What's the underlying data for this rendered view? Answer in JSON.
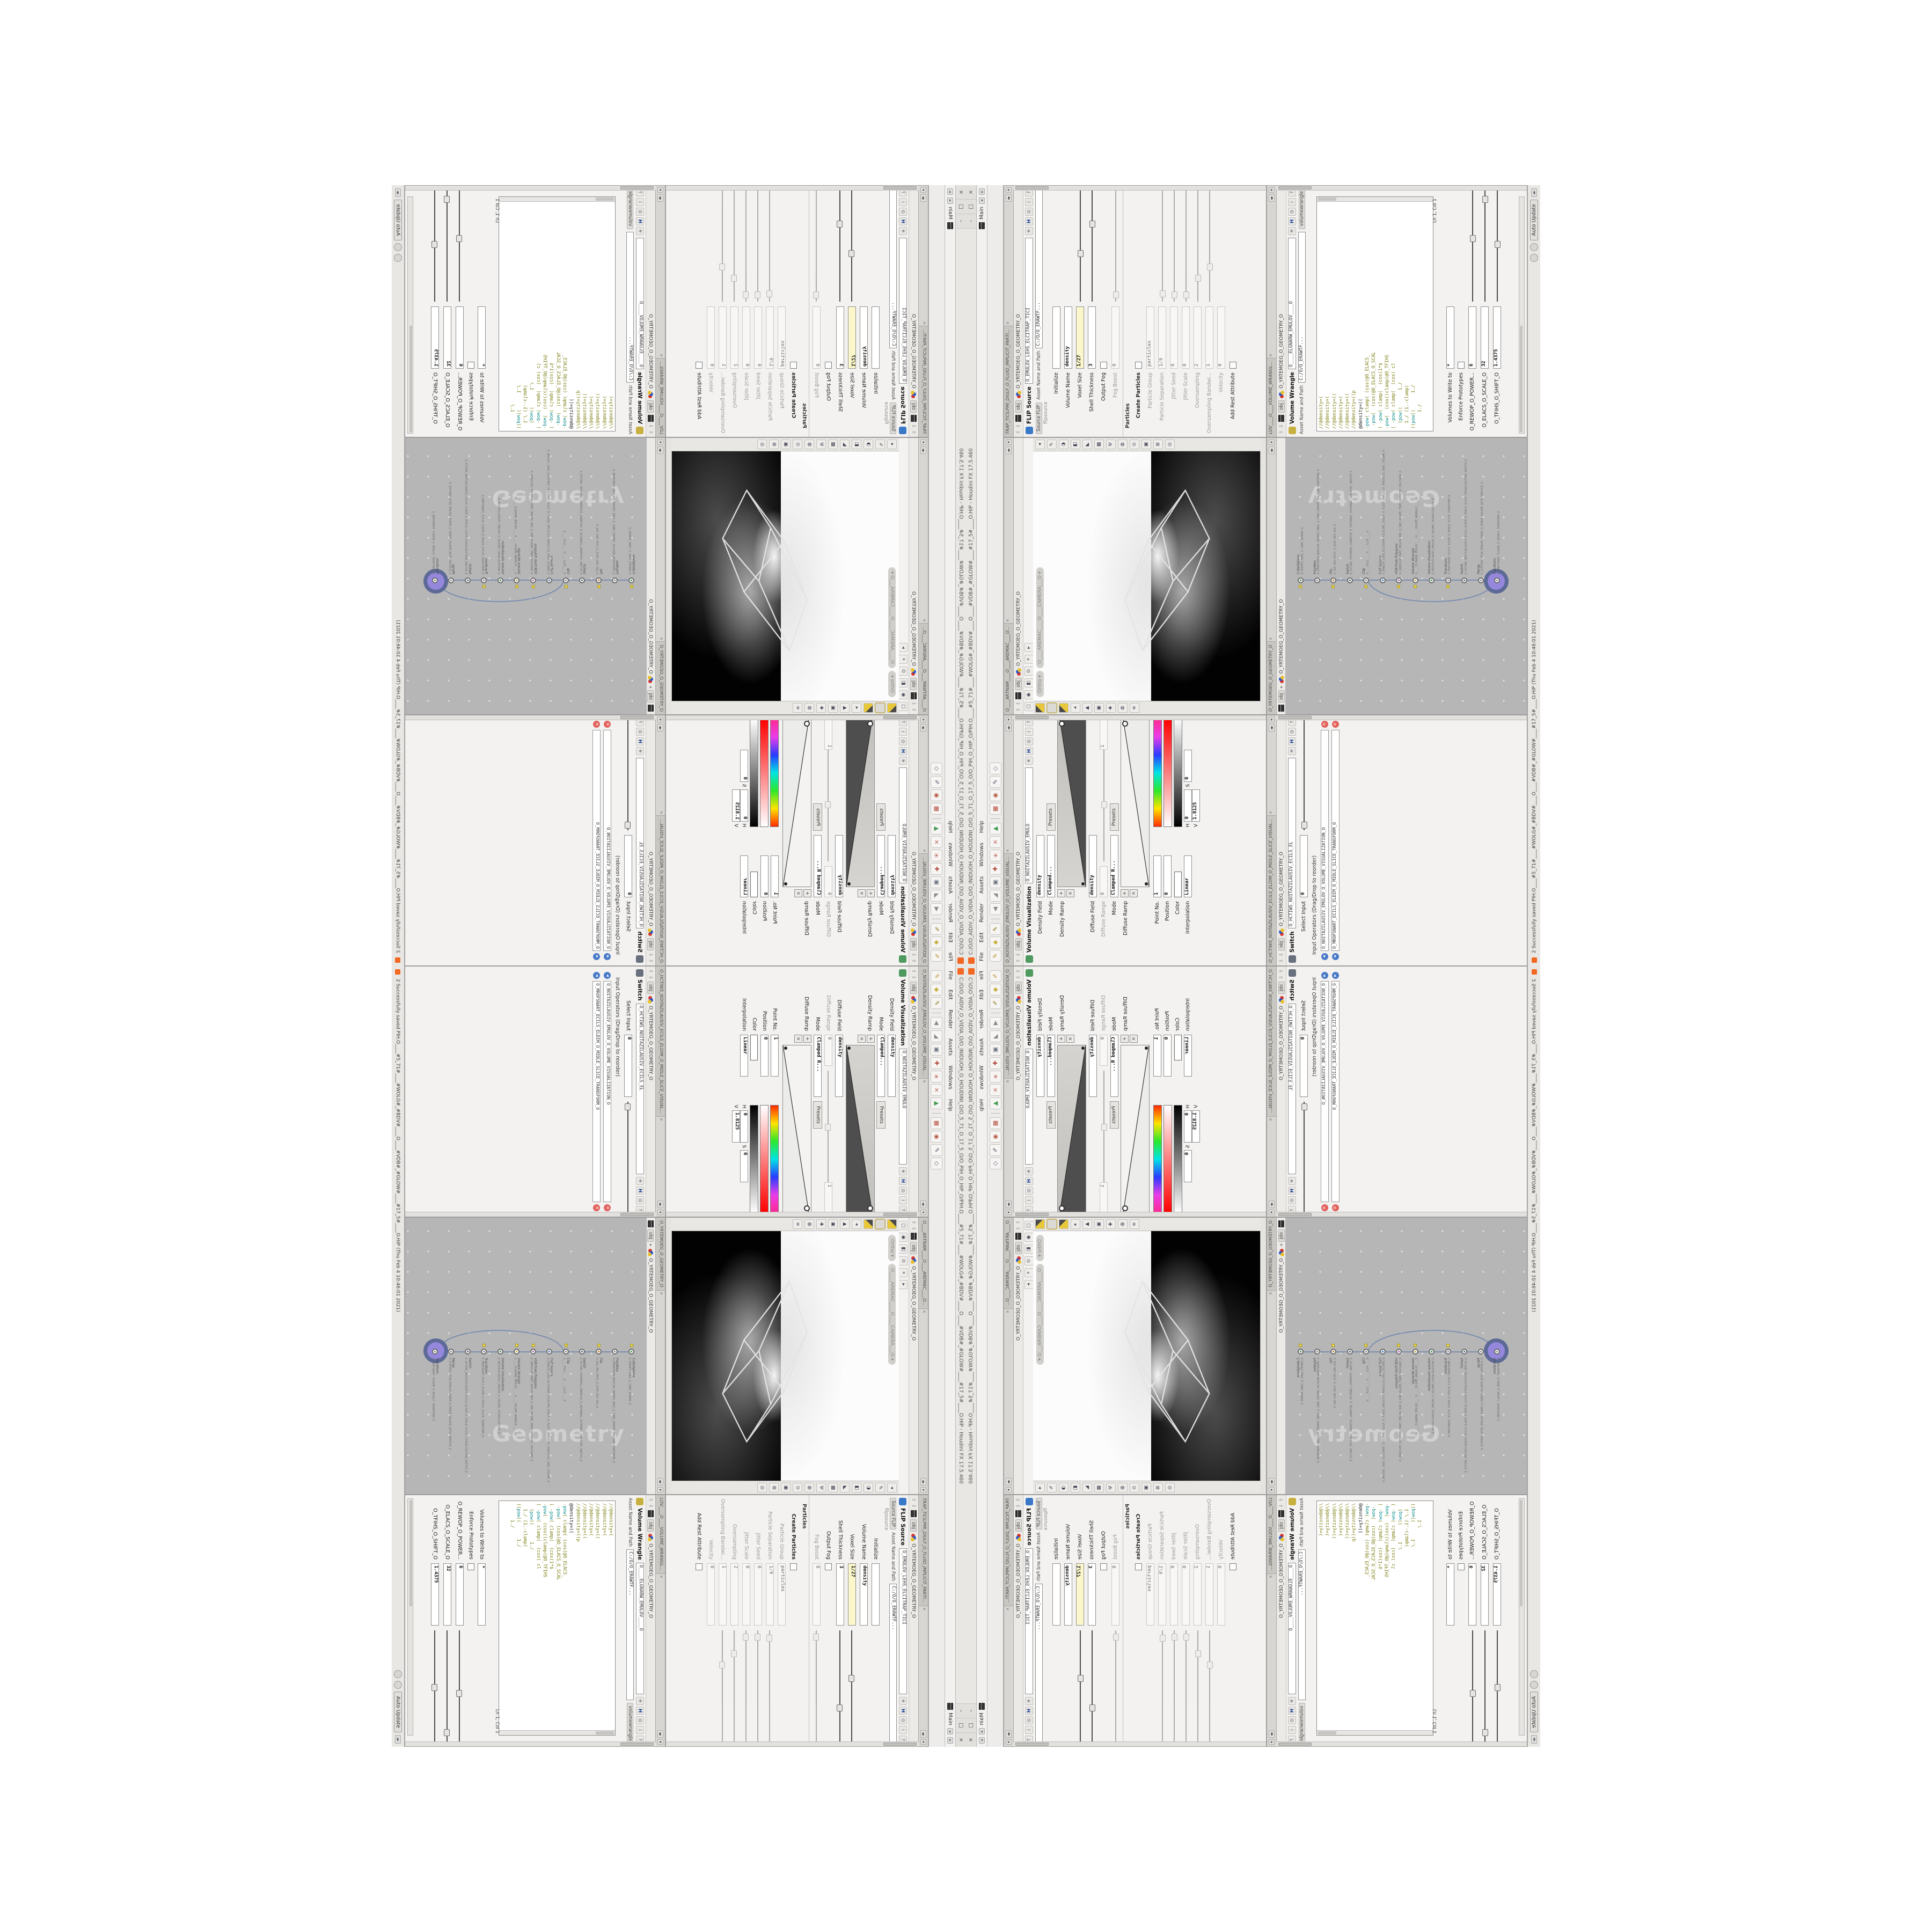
{
  "colors": {
    "accent_purple": "#9487dc",
    "ring_slate": "#5d6a97",
    "network_bg": "#b6b6b6",
    "code_olive": "#7e7e14",
    "code_teal": "#0c8c8c",
    "yellow_field": "#fbf7cb",
    "flag_yellow": "#e4cf47",
    "close_red": "#e2615c",
    "link_blue": "#4a7ac8",
    "houdini_orange": "#f26722"
  },
  "window": {
    "title": "C:/O/O_AIDIV_O_VIDIA_O/O_INIDUOH_O_HOUDINI_O/O_5_71_O_17_5_O/O_PIH_O_HIP_O/PIH.O____#5_71#____#WOLG#_#BDV#____O____#VDB#_#GLOW#____#17_5#____O.HIP - Houdini FX 17.5.460",
    "btn_min": "–",
    "btn_max": "□",
    "btn_close": "×"
  },
  "menubar": {
    "menus": [
      "File",
      "Edit",
      "Render",
      "Assets",
      "Windows",
      "Help"
    ],
    "desktop_label": "Main",
    "nav_left": "◂",
    "nav_right": "▸"
  },
  "shelf": {
    "icons": [
      {
        "g": "✎",
        "c": "#b9952e"
      },
      {
        "g": "◆",
        "c": "#c8b040"
      },
      {
        "g": "✎",
        "c": "#8f7a20"
      },
      {
        "g": "|",
        "c": "#999"
      },
      {
        "g": "◀",
        "c": "#8a8a8a"
      },
      {
        "g": "◢",
        "c": "#8a8a8a"
      },
      {
        "g": "▣",
        "c": "#68707e"
      },
      {
        "g": "✚",
        "c": "#b3493a"
      },
      {
        "g": "＊",
        "c": "#b3493a"
      },
      {
        "g": "×",
        "c": "#b3493a"
      },
      {
        "g": "▲",
        "c": "#3f9a4f"
      },
      {
        "g": "|",
        "c": "#999"
      },
      {
        "g": "▦",
        "c": "#b3493a"
      },
      {
        "g": "◉",
        "c": "#b3543c"
      },
      {
        "g": "✎",
        "c": "#5a6070"
      },
      {
        "g": "◇",
        "c": "#5a6070"
      }
    ]
  },
  "volvis": {
    "tab": "O_NOITAZILAUSIV_EMULOV_O_VOLUME_VISUAL...",
    "context": "obj",
    "path": "O_YRTEMOEG_O_GEOMETRY_O",
    "type_label": "Volume Visualization",
    "name": "O_NOITAZILAUSIV_EMULO",
    "density_field_label": "Density Field",
    "density_field": "density",
    "mode_label": "Mode",
    "mode": "Clamped...",
    "presets": "Presets",
    "density_ramp_label": "Density Ramp",
    "diffuse_field_label": "Diffuse Field",
    "diffuse_field": "density",
    "diffuse_range_label": "Diffuse Range",
    "diffuse_range_min": "0",
    "diffuse_range_max": "1",
    "mode2_label": "Mode",
    "mode2": "Clamped R...",
    "presets2": "Presets",
    "diffuse_ramp_label": "Diffuse Ramp",
    "point_label": "Point No.",
    "point": "1",
    "position_label": "Position",
    "position": "0",
    "color_label": "Color",
    "interp_label": "Interpolation",
    "interp": "Linear",
    "h_label": "H",
    "h": "0",
    "s_label": "S",
    "s": "0",
    "v_label": "V",
    "v": "1.8125"
  },
  "switchpane": {
    "tab": "O_HCTIWS_NOITAZILAUSIV_ECILS_ELDIM_O_MIDLE_SLICE_VISUAL...",
    "context": "obj",
    "path": "O_YRTEMOEG_O_GEOMETRY_O",
    "type_label": "Switch",
    "name": "O_HCTIWS_NOITAZILAUSIV_ECILS_EL",
    "select_label": "Select Input",
    "select_value": "0",
    "inputs_label": "Input Operators (Drag/Drop to reorder)",
    "inputs": [
      "O_NOITAZILAUSIV_EMULOV_O_VOLUME_VISUALIZATION_O",
      "O_MROFSNART_ECILS_ELDIM_O_MIDLE_SLICE_TRANSFORM_O"
    ],
    "remove_glyph": "×",
    "reorder_glyph": "◂"
  },
  "viewport": {
    "tab": "O____ARTNAM____O____AREMAC____O...",
    "context": "obj",
    "path": "O_YRTEMOEG_O_GEOMETRY_O",
    "pill_projection": "Ortho ▾",
    "pill_camera": "O____AREMAC____O____CAMERA___O ▾",
    "top_icons": [
      "▢",
      "◉",
      "◧",
      "⊙",
      "⌖",
      "▸"
    ],
    "left_icons": [
      "◖",
      "◗",
      "◒",
      "◂",
      "▲",
      "▣",
      "✚",
      "◍",
      "≡"
    ],
    "right_icons": [
      "◂",
      "✎",
      "◑",
      "◧",
      "◣",
      "▩",
      "Ψ",
      "◍",
      "⊙",
      "▣",
      "⊞",
      "◎"
    ]
  },
  "network": {
    "context": "obj",
    "path": "O_YRTEMOEG_O_GEOMETRY_O",
    "watermark": "Geometry",
    "nodes": [
      {
        "t": "CubeSphere",
        "n": "O_EREHPS_EBUC_O_CUBE_SPHERE_O",
        "c": "#3f9a4f",
        "flag": true
      },
      {
        "t": "PolyWire",
        "n": "O_EMARFERIW_NOGYLOP_EREHPS_EBUC_O_CUBE_SPHERE_POLYGON_WIREFRAME_O",
        "c": "#8a8a8a",
        "flag": false
      },
      {
        "t": "File",
        "n": "O_GES.M03.PETS_O_STEP.M03.SEG_O",
        "c": "#c8762c",
        "flag": true
      },
      {
        "t": "Switch",
        "n": "O_HCTIWS_YRTEMOEG_LANRETXE_O_INTERNAL_EXTERNAL_GEOMETRY_SWITCH_O",
        "c": "#5a6070",
        "flag": false
      },
      {
        "t": "Clip",
        "n": "O____PILC____O____CLIP____O",
        "c": "#8a8a8a",
        "flag": true
      },
      {
        "t": "FLIP Source",
        "n": "O_EMULOV_LEHS_ELCITRAP_TICILPMI_DIULF_O_FLUID_IMPLICIT_PARTICLE_SHEL_VOLUME_O",
        "c": "#3a78c8",
        "flag": false
      },
      {
        "t": "VDB from Polygons",
        "n": "O_SNOGYLOP_MORF_EMULOV_BDV_O_VDB_VOLUME_FROM_GEOMETRY_POLYGONS_O",
        "c": "#b05a9a",
        "flag": true
      },
      {
        "t": "Volume Wrangle",
        "n": "O____ELGNARW_EMULOV____O____VOLUME_WRANGLE____O2",
        "c": "#c8b040",
        "flag": true
      },
      {
        "t": "Volume Visualization",
        "n": "O_NOITAZILAUSIV_EMULOV_O_VOLUME_VISUALIZATION_O",
        "c": "#3f9a4f",
        "flag": false
      },
      {
        "t": "Transform",
        "n": "O_MROFSNART_ECILS_ELDIM_O_MIDLE_SLICE_TRANSFORM_O",
        "c": "#8a8a8a",
        "flag": true
      },
      {
        "t": "Switch",
        "n": "O_HCTIWS_NOITAZILAUSIV_ECILS_ELDIM_O_MIDLE_SLICE_VISUALIZATION_SWITCH_O",
        "c": "#5a6070",
        "flag": false
      },
      {
        "t": "Merge",
        "n": "O_ECAFRUS_HTIW_EMULOV_EGREM_O_MERGE_VOLUME_WITH_SURFACE_O",
        "c": "#8a8a8a",
        "flag": false
      },
      {
        "t": "Transform",
        "n": "O_MROFSNART_TLUSER_O_RESULT_TRANSFORM_O",
        "c": "#8a8a8a",
        "flag": false,
        "sel": true
      }
    ]
  },
  "flip": {
    "tab": "TRAP_TICILPMI_DIULF_O_FLUID_IMPLICIT_PARTI...",
    "context": "obj",
    "path": "O_YRTEMOEG_O_GEOMETRY_O",
    "type_label": "FLIP Source",
    "name": "O_EMULOV_LEHS_ELCITRAP_TICI",
    "subtype": "flipsource",
    "hda_tab": "Source FLIP",
    "asset_label": "Asset Name and Path",
    "asset_path": "C:/O/O_ERAWTF...",
    "rows": [
      {
        "label": "Initialize",
        "value": "",
        "kind": "field"
      },
      {
        "label": "Volume Name",
        "value": "density",
        "kind": "field"
      },
      {
        "label": "Voxel Size",
        "value": "1/27",
        "kind": "yellow",
        "s": 0.42
      },
      {
        "label": "Shell Thickness",
        "value": "3",
        "kind": "field",
        "s": 0.68
      },
      {
        "label": "Output Fog",
        "kind": "check"
      },
      {
        "label": "Fog Boost",
        "value": "0",
        "kind": "disabled",
        "s": 0.05
      },
      {
        "label": "Particles",
        "kind": "section"
      },
      {
        "label": "Create Particles",
        "kind": "checkbold"
      },
      {
        "label": "Particle Group",
        "value": "particles",
        "kind": "disabled"
      },
      {
        "label": "Particle Separation",
        "value": "1/9",
        "kind": "disabled",
        "s": 0.06
      },
      {
        "label": "Jitter Seed",
        "value": "0",
        "kind": "disabled",
        "s": 0.05
      },
      {
        "label": "Jitter Scale",
        "value": "0",
        "kind": "disabled",
        "s": 0.05
      },
      {
        "label": "Oversampling",
        "value": "2",
        "kind": "disabled",
        "s": 0.2
      },
      {
        "label": "Oversampling Bandwi...",
        "value": "1",
        "kind": "disabled",
        "s": 0.3
      },
      {
        "label": "Velocity",
        "value": "0",
        "kind": "disabled"
      },
      {
        "label": "Add Rest Attribute",
        "kind": "check"
      }
    ]
  },
  "wrangle": {
    "tab": "LOV____O____VOLUME_WRANGL...",
    "context": "obj",
    "path": "O_YRTEMOEG_O_GEOMETRY_O",
    "type_label": "Volume Wrangle",
    "name": "O____ELGNARW_EMULOV____O",
    "subtype": "volumewrangle",
    "asset_label": "Asset Name and Path",
    "asset_path": "C:/O/O_ERAWTF...",
    "code": [
      "//@density=(",
      "//@density=(",
      "//@density=((",
      "//@density=(",
      "//@density=((",
      "//@density=((p",
      "@density=((",
      "-pow( clamp( (cos(@O_ELACS_",
      " -pow(  (cos(@O_ELACS_O_SCAL",
      "( -pow( clamp(  (cos(1*$",
      "-pow(  (cos((clamp(@O_TFIHS",
      "( -pow( clamp(  (cos( cl",
      "  (pow((      1./",
      "  1./ (1.-clamp(",
      "((pow((      1./",
      "      1./"
    ],
    "active_line_index": 6,
    "cursor": "Ln 1, Col 1",
    "volumes_label": "Volumes to Write to",
    "volumes": "*",
    "enforce_label": "Enforce Prototypes",
    "spares": [
      {
        "label": "O_REWOP_O_POWER...",
        "value": "6",
        "s": 0.55
      },
      {
        "label": "O_ELACS_O_SCALE_O",
        "value": "32",
        "s": 0.9
      },
      {
        "label": "O_TFIHS_O_SHIFT_O",
        "value": "1.4375",
        "s": 0.5
      }
    ]
  },
  "statusbar": {
    "message": "2 Successfully saved PIH.O____#5_71#____#WOLG#_#BDV#____O____#VDB#_#GLOW#____#17_5#____O.HIP (Thu Feb  4 10:46:01 2021)",
    "auto_update": "Auto Update"
  }
}
